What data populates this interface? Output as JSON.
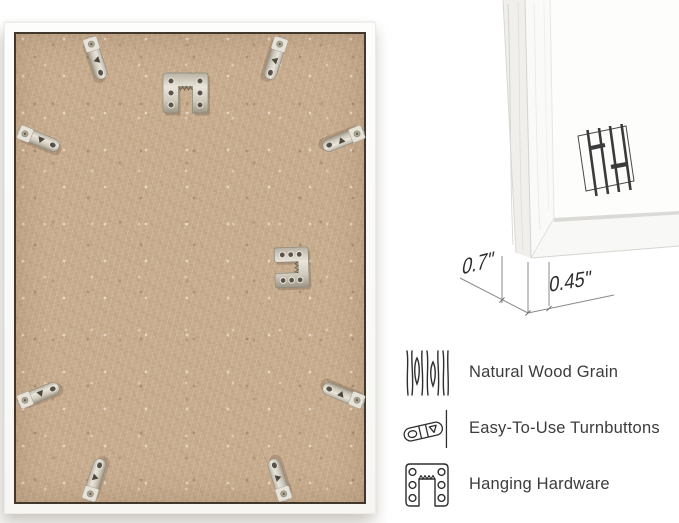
{
  "measurements": {
    "depth": "0.7\"",
    "face_width": "0.45\""
  },
  "features": [
    {
      "icon": "wood-grain-icon",
      "label": "Natural Wood Grain"
    },
    {
      "icon": "turnbutton-icon",
      "label": "Easy-To-Use Turnbuttons"
    },
    {
      "icon": "hanging-hardware-icon",
      "label": "Hanging Hardware"
    }
  ],
  "frame_back": {
    "backing_color": "#c7ab8d",
    "frame_color": "#fbfbf9",
    "hardware": {
      "turnbutton_count": 8,
      "top_hanger": "sawtooth-hanger",
      "center_bracket": "hanging-bracket"
    }
  },
  "closeup": {
    "logo_icon": "brand-hh-logo-icon",
    "mat_color": "#fdfdfc"
  },
  "colors": {
    "dimension_line": "#8b8b8b",
    "feature_text": "#3c3c3c",
    "icon_stroke": "#2e2e2e",
    "mdf_border": "#41372a"
  }
}
